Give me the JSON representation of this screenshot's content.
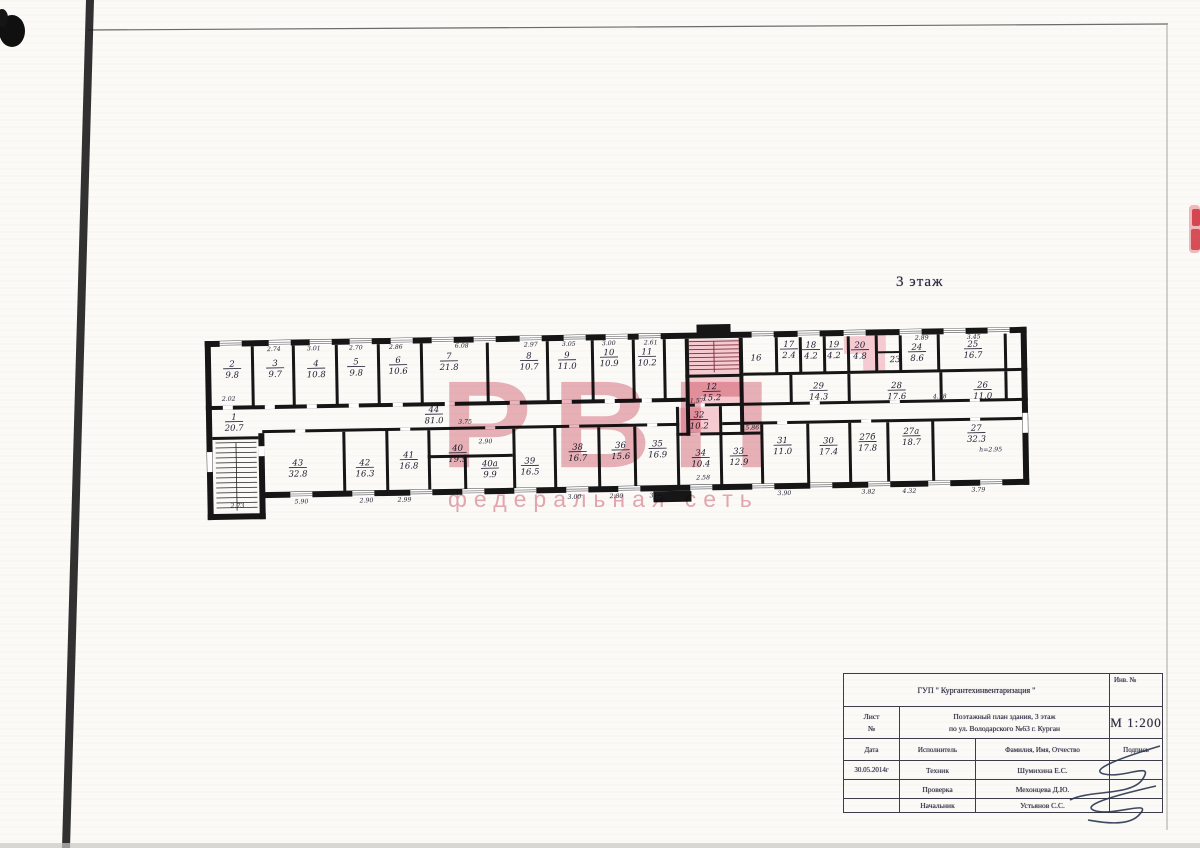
{
  "page": {
    "floor_title": "3 этаж"
  },
  "watermark": {
    "big": "РВП",
    "sub": "федеральная сеть",
    "big_color": "#d96f80",
    "sub_color": "#dc8494"
  },
  "plan": {
    "highlight_color": "#f2aab6",
    "rooms": [
      {
        "n": "1",
        "a": "20.7",
        "x": 234,
        "y": 413
      },
      {
        "n": "2",
        "a": "9.8",
        "x": 233,
        "y": 360
      },
      {
        "n": "3",
        "a": "9.7",
        "x": 276,
        "y": 360
      },
      {
        "n": "4",
        "a": "10.8",
        "x": 317,
        "y": 361
      },
      {
        "n": "5",
        "a": "9.8",
        "x": 357,
        "y": 360
      },
      {
        "n": "6",
        "a": "10.6",
        "x": 399,
        "y": 359
      },
      {
        "n": "7",
        "a": "21.8",
        "x": 450,
        "y": 356
      },
      {
        "n": "8",
        "a": "10.7",
        "x": 530,
        "y": 357
      },
      {
        "n": "9",
        "a": "11.0",
        "x": 568,
        "y": 357
      },
      {
        "n": "10",
        "a": "10.9",
        "x": 610,
        "y": 355
      },
      {
        "n": "11",
        "a": "10.2",
        "x": 648,
        "y": 355
      },
      {
        "n": "12",
        "a": "15.2",
        "x": 712,
        "y": 391
      },
      {
        "n": "32",
        "a": "10.2",
        "x": 699,
        "y": 419
      },
      {
        "n": "44",
        "a": "81.0",
        "x": 434,
        "y": 409
      },
      {
        "n": "16",
        "a": "",
        "x": 757,
        "y": 363
      },
      {
        "n": "17",
        "a": "2.4",
        "x": 790,
        "y": 350
      },
      {
        "n": "18",
        "a": "4.2",
        "x": 812,
        "y": 351
      },
      {
        "n": "19",
        "a": "4.2",
        "x": 835,
        "y": 351
      },
      {
        "n": "20",
        "a": "4.8",
        "x": 861,
        "y": 352
      },
      {
        "n": "23",
        "a": "",
        "x": 896,
        "y": 367
      },
      {
        "n": "24",
        "a": "8.6",
        "x": 918,
        "y": 355
      },
      {
        "n": "25",
        "a": "16.7",
        "x": 974,
        "y": 353
      },
      {
        "n": "29",
        "a": "14.3",
        "x": 819,
        "y": 392
      },
      {
        "n": "28",
        "a": "17.6",
        "x": 897,
        "y": 393
      },
      {
        "n": "26",
        "a": "11.0",
        "x": 983,
        "y": 394
      },
      {
        "n": "34",
        "a": "10.4",
        "x": 700,
        "y": 457
      },
      {
        "n": "33",
        "a": "12.9",
        "x": 738,
        "y": 456
      },
      {
        "n": "31",
        "a": "11.0",
        "x": 782,
        "y": 446
      },
      {
        "n": "30",
        "a": "17.4",
        "x": 828,
        "y": 447
      },
      {
        "n": "27б",
        "a": "17.8",
        "x": 867,
        "y": 444
      },
      {
        "n": "27а",
        "a": "18.7",
        "x": 911,
        "y": 439
      },
      {
        "n": "27",
        "a": "32.3",
        "x": 976,
        "y": 437
      },
      {
        "n": "35",
        "a": "16.9",
        "x": 657,
        "y": 447
      },
      {
        "n": "36",
        "a": "15.6",
        "x": 620,
        "y": 448
      },
      {
        "n": "38",
        "a": "16.7",
        "x": 577,
        "y": 449
      },
      {
        "n": "39",
        "a": "16.5",
        "x": 529,
        "y": 462
      },
      {
        "n": "40а",
        "a": "9.9",
        "x": 489,
        "y": 464
      },
      {
        "n": "40",
        "a": "19.9",
        "x": 457,
        "y": 448
      },
      {
        "n": "41",
        "a": "16.8",
        "x": 408,
        "y": 454
      },
      {
        "n": "42",
        "a": "16.3",
        "x": 364,
        "y": 461
      },
      {
        "n": "43",
        "a": "32.8",
        "x": 297,
        "y": 460
      }
    ],
    "dims": [
      {
        "t": "2.74",
        "x": 275,
        "y": 345
      },
      {
        "t": "3.01",
        "x": 315,
        "y": 345
      },
      {
        "t": "2.70",
        "x": 357,
        "y": 345
      },
      {
        "t": "2.86",
        "x": 397,
        "y": 345
      },
      {
        "t": "6.08",
        "x": 463,
        "y": 345
      },
      {
        "t": "2.97",
        "x": 532,
        "y": 345
      },
      {
        "t": "3.05",
        "x": 570,
        "y": 345
      },
      {
        "t": "3.00",
        "x": 610,
        "y": 345
      },
      {
        "t": "2.61",
        "x": 652,
        "y": 345
      },
      {
        "t": "2.89",
        "x": 923,
        "y": 345
      },
      {
        "t": "3.45",
        "x": 975,
        "y": 345
      },
      {
        "t": "2.02",
        "x": 229,
        "y": 394
      },
      {
        "t": "3.75",
        "x": 465,
        "y": 421
      },
      {
        "t": "1.57",
        "x": 697,
        "y": 404
      },
      {
        "t": "5.86",
        "x": 752,
        "y": 432
      },
      {
        "t": "4.18",
        "x": 940,
        "y": 404
      },
      {
        "t": "2.90",
        "x": 485,
        "y": 441
      },
      {
        "t": "2.73",
        "x": 236,
        "y": 501
      },
      {
        "t": "5.90",
        "x": 300,
        "y": 498
      },
      {
        "t": "2.90",
        "x": 365,
        "y": 498
      },
      {
        "t": "2.99",
        "x": 403,
        "y": 498
      },
      {
        "t": "3.00",
        "x": 573,
        "y": 498
      },
      {
        "t": "2.80",
        "x": 615,
        "y": 498
      },
      {
        "t": "3.02",
        "x": 655,
        "y": 498
      },
      {
        "t": "2.58",
        "x": 702,
        "y": 481
      },
      {
        "t": "3.90",
        "x": 783,
        "y": 498
      },
      {
        "t": "3.82",
        "x": 867,
        "y": 498
      },
      {
        "t": "4.32",
        "x": 908,
        "y": 498
      },
      {
        "t": "3.79",
        "x": 977,
        "y": 498
      },
      {
        "t": "h=2.95",
        "x": 990,
        "y": 458
      }
    ]
  },
  "title_block": {
    "org": "ГУП \" Кургантехинвентаризация \"",
    "inv": "Инв. №",
    "sheet_label": "Лист",
    "sheet_no": "№",
    "title_line1": "Поэтажный план здания, 3 этаж",
    "title_line2": "по ул. Володарского №63 г. Курган",
    "scale": "М 1:200",
    "col_date": "Дата",
    "col_executor": "Исполнитель",
    "col_name": "Фамилия, Имя, Отчество",
    "col_sign": "Подпись",
    "date": "30.05.2014г",
    "rows": [
      {
        "role": "Техник",
        "name": "Шумихина Е.С."
      },
      {
        "role": "Проверка",
        "name": "Мехонцева Д.Ю."
      },
      {
        "role": "Начальник",
        "name": "Устьянов С.С."
      }
    ]
  }
}
